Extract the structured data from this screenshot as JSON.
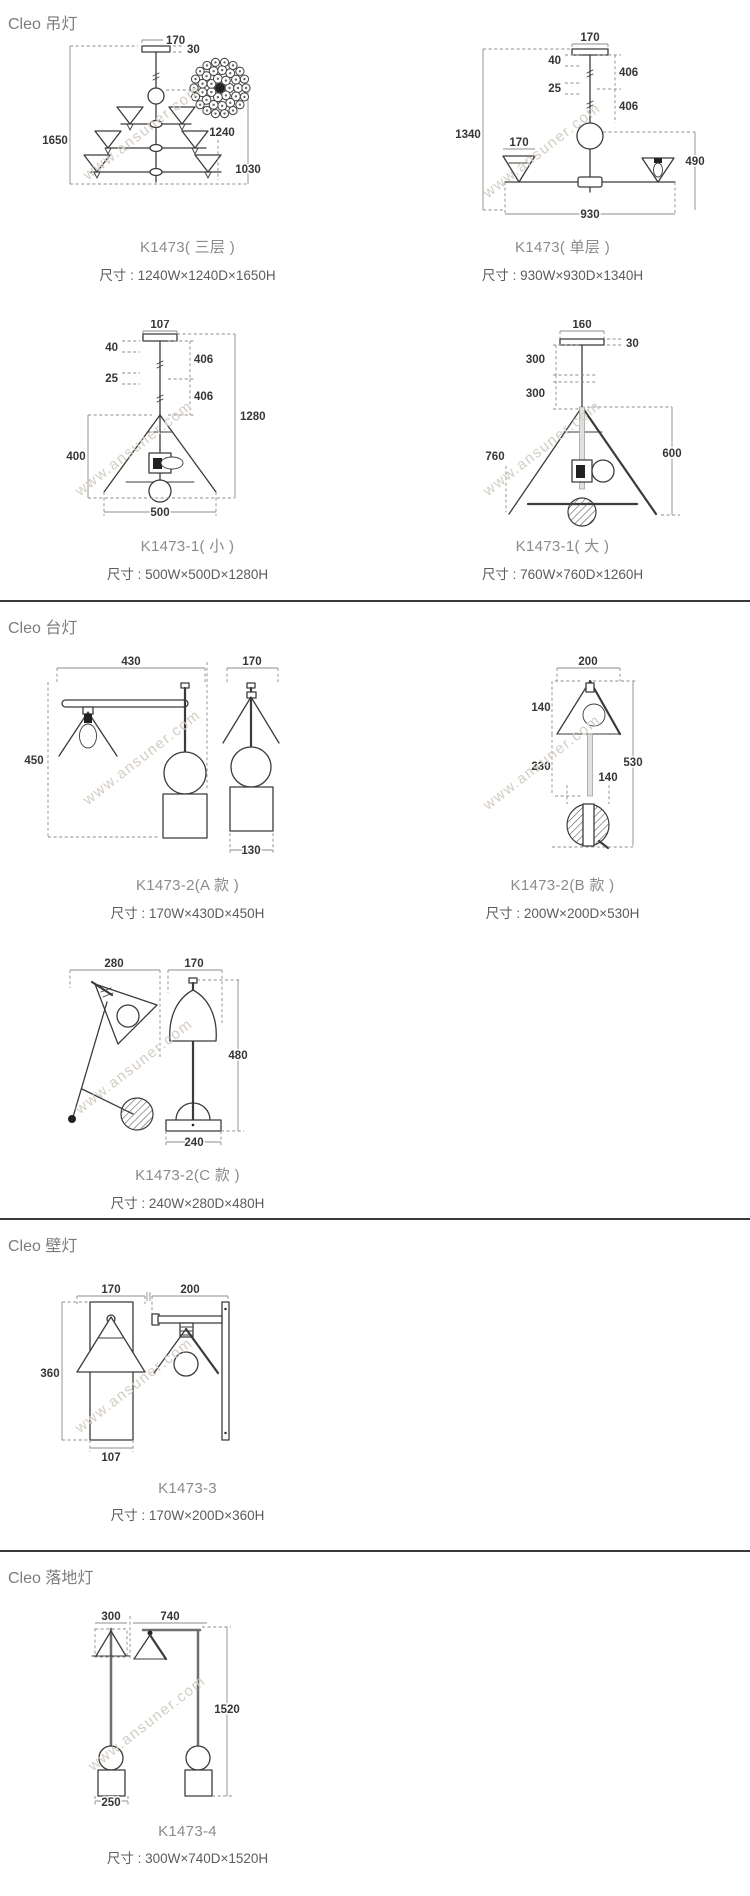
{
  "watermark": "www.ansuner.com",
  "colors": {
    "divider": "#383838",
    "heading": "#7c7c7c",
    "caption_name": "#8b8b8b",
    "caption_size": "#5c5c5c",
    "line": "#3b3b3b",
    "dim_text": "#363636",
    "watermark": "#d3cdc4"
  },
  "sections": [
    {
      "title": "Cleo 吊灯",
      "products": [
        {
          "name": "K1473( 三层 )",
          "size": "尺寸 : 1240W×1240D×1650H",
          "dims": {
            "canopy_w": "170",
            "canopy_h": "30",
            "total_h": "1650",
            "width": "1240",
            "body_h": "1030"
          }
        },
        {
          "name": "K1473( 单层 )",
          "size": "尺寸 : 930W×930D×1340H",
          "dims": {
            "canopy_w": "170",
            "gap1": "40",
            "rod1": "406",
            "gap2": "25",
            "rod2": "406",
            "total_h": "1340",
            "shade_w": "170",
            "body_h": "490",
            "width": "930"
          }
        },
        {
          "name": "K1473-1( 小 )",
          "size": "尺寸 : 500W×500D×1280H",
          "dims": {
            "canopy_w": "107",
            "gap1": "40",
            "rod1": "406",
            "gap2": "25",
            "rod2": "406",
            "shade_h": "400",
            "total_h": "1280",
            "width": "500"
          }
        },
        {
          "name": "K1473-1( 大 )",
          "size": "尺寸 : 760W×760D×1260H",
          "dims": {
            "canopy_w": "160",
            "canopy_h": "30",
            "rod1": "300",
            "rod2": "300",
            "width": "760",
            "shade_h": "600"
          }
        }
      ]
    },
    {
      "title": "Cleo 台灯",
      "products": [
        {
          "name": "K1473-2(A 款 )",
          "size": "尺寸 : 170W×430D×450H",
          "dims": {
            "depth": "430",
            "shade_w": "170",
            "total_h": "450",
            "base_w": "130"
          }
        },
        {
          "name": "K1473-2(B 款 )",
          "size": "尺寸 : 200W×200D×530H",
          "dims": {
            "shade_w": "200",
            "shade_h": "140",
            "rod": "230",
            "ball": "140",
            "total_h": "530"
          }
        },
        {
          "name": "K1473-2(C 款 )",
          "size": "尺寸 : 240W×280D×480H",
          "dims": {
            "depth": "280",
            "shade_w": "170",
            "total_h": "480",
            "base_w": "240"
          }
        }
      ]
    },
    {
      "title": "Cleo 壁灯",
      "products": [
        {
          "name": "K1473-3",
          "size": "尺寸 : 170W×200D×360H",
          "dims": {
            "shade_w": "170",
            "depth": "200",
            "total_h": "360",
            "plate_w": "107"
          }
        }
      ]
    },
    {
      "title": "Cleo 落地灯",
      "products": [
        {
          "name": "K1473-4",
          "size": "尺寸 : 300W×740D×1520H",
          "dims": {
            "shade_w": "300",
            "depth": "740",
            "total_h": "1520",
            "base_w": "250"
          }
        }
      ]
    }
  ]
}
